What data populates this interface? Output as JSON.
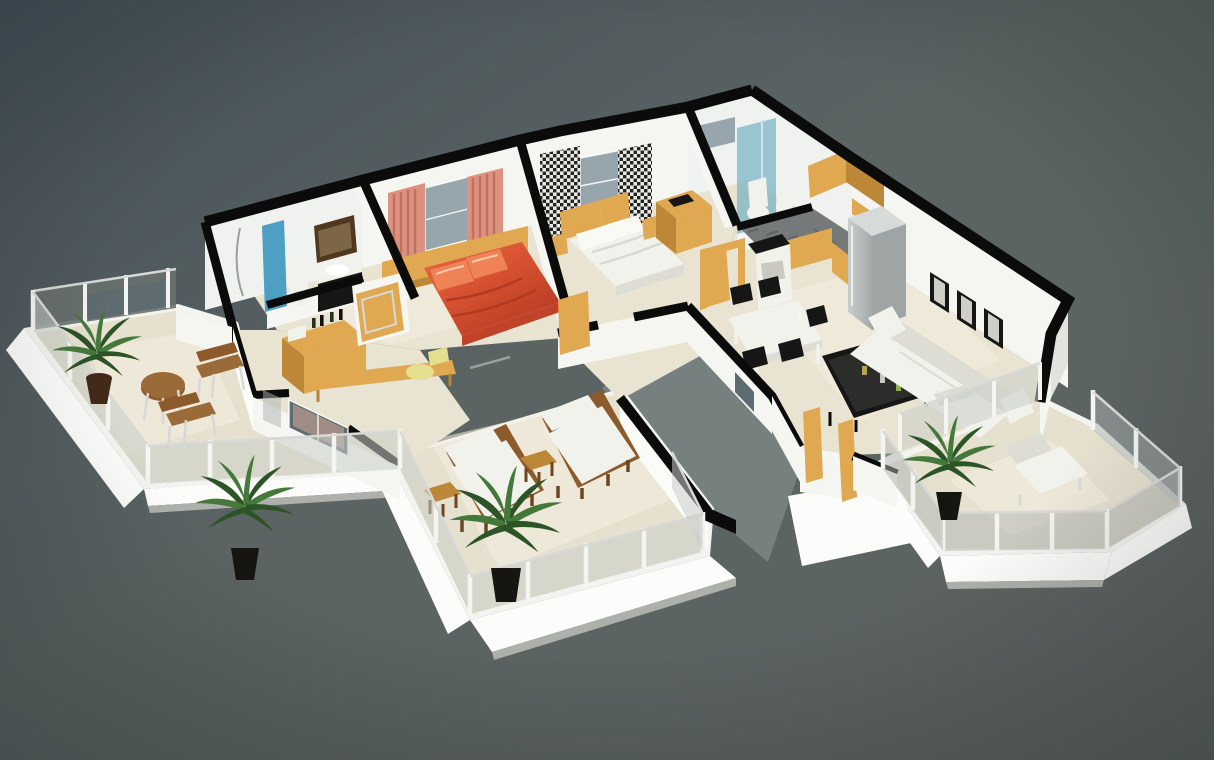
{
  "scene": {
    "description": "3D isometric dollhouse-style cutaway rendering of an apartment floor plan on a gray studio background. White walls with black cut tops, beige tiled floors, three outdoor terraces with glass railings and palm plants.",
    "rooms": {
      "bathroom1": {
        "name": "en-suite bathroom",
        "items": [
          "toilet",
          "dark vanity with sink",
          "wall mirror",
          "blue shower partition",
          "hand shower"
        ]
      },
      "bedroom1": {
        "name": "master bedroom",
        "items": [
          "red double bed with satin pillows",
          "wood headboard bench",
          "window",
          "salmon striped curtains",
          "desk with yellow chair",
          "wood sideboard with bottles",
          "wardrobe door"
        ]
      },
      "bedroom2": {
        "name": "second bedroom",
        "items": [
          "white double bed",
          "wood headboard panels",
          "two nightstands",
          "window",
          "black-and-white patterned curtains",
          "wood dresser",
          "wardrobe door"
        ]
      },
      "bathroom2": {
        "name": "shower bathroom",
        "items": [
          "teal glass shower enclosure",
          "toilet",
          "bidet",
          "small window"
        ]
      },
      "kitchen": {
        "name": "kitchen",
        "items": [
          "L-shaped oak cabinets",
          "gray marble countertop",
          "range cooker",
          "stainless refrigerator",
          "oak upper cabinets",
          "door frame"
        ]
      },
      "dining": {
        "name": "dining area",
        "items": [
          "white dining table",
          "five black chairs"
        ]
      },
      "living": {
        "name": "living room",
        "items": [
          "white three-seat sofa",
          "white armchair",
          "black coffee table with cans",
          "three black picture frames",
          "glass wall to balcony"
        ]
      },
      "hall": {
        "name": "hallway and light well",
        "items": [
          "wood door leaves",
          "open gray light well",
          "small wall windows"
        ]
      },
      "left_balcony": {
        "name": "left balcony",
        "items": [
          "glass railing",
          "palm in clay pot",
          "round teak bistro table",
          "two teak-and-chrome chairs"
        ]
      },
      "terrace": {
        "name": "main sun terrace",
        "items": [
          "two wood sun loungers with cream cushions",
          "two small teak side tables",
          "palm in black pot",
          "corner palm",
          "glass railing"
        ]
      },
      "right_balcony": {
        "name": "right balcony",
        "items": [
          "glass railing",
          "palm in black pot",
          "white lounge chair"
        ]
      }
    }
  },
  "palette": {
    "bg_a": "#46525A",
    "bg_b": "#5E6562",
    "bg_void": "#76807F",
    "floor": "#E9E3D1",
    "floor_light": "#F4EFE0",
    "terrace_floor": "#E6E0CF",
    "wall": "#F5F5F1",
    "wall_bright": "#FBFBF8",
    "wall_shade": "#E3E3DD",
    "wall_dim": "#D2D3CD",
    "cap": "#0B0B0B",
    "slab": "#F3F3EF",
    "slab_face": "#FCFCFA",
    "slab_shadow": "#AEB1AB",
    "wood": "#E0A851",
    "wood_dark": "#BC8736",
    "wood_deep": "#8C5A2B",
    "counter": "#75797A",
    "steel": "#B9BEBE",
    "white_f": "#F2F2EC",
    "white_f_shade": "#DDDDD4",
    "black_f": "#161616",
    "bed_red": "#D5502F",
    "bed_red_light": "#F08355",
    "curtain": "#DD9181",
    "curtain_stripe": "#C4705F",
    "glass_blue": "#62AABE",
    "glass_blue_deep": "#4D9FC4",
    "glass_dark": "#69716F",
    "glass_light": "#C9CEC9",
    "glass_pane": "#AEB4B1",
    "metal": "#D6D9D7",
    "plant": "#2C5426",
    "plant_light": "#45793B",
    "pot_brown": "#42291A",
    "pot_black": "#171512",
    "window": "#97A6AC",
    "window_dark": "#5E6B70",
    "tile": "#EFF2EE",
    "mirror": "#50371E",
    "chair_yellow": "#E4DE8F"
  }
}
